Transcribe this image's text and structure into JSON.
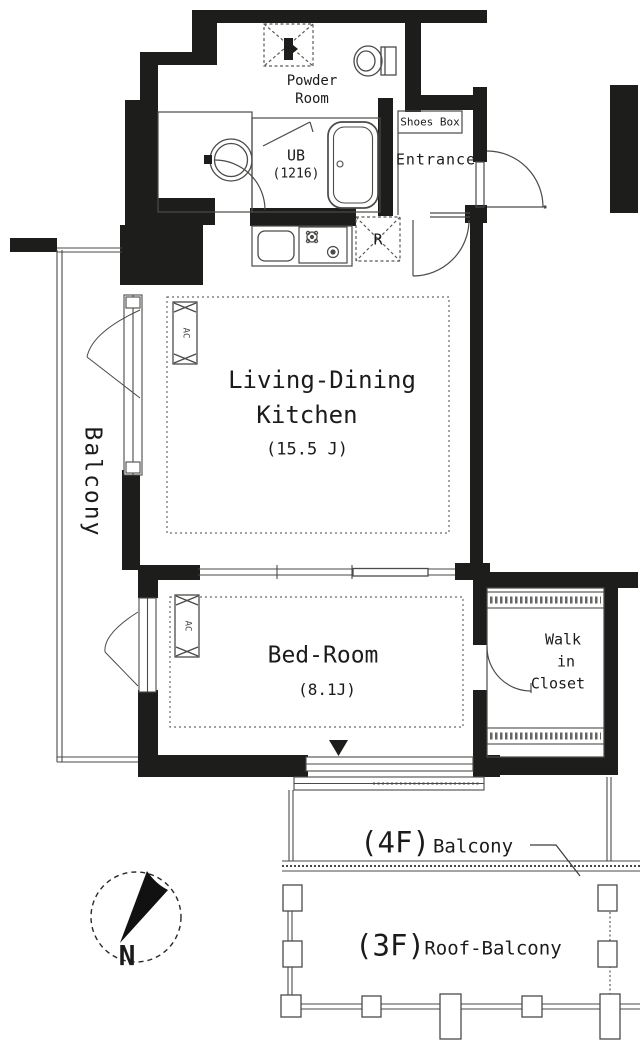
{
  "rooms": {
    "powder_room": {
      "line1": "Powder",
      "line2": "Room"
    },
    "unit_bath": {
      "label": "UB",
      "size": "(1216)"
    },
    "shoes_box": {
      "label": "Shoes Box"
    },
    "entrance": {
      "label": "Entrance"
    },
    "living_dining_kitchen": {
      "line1": "Living-Dining",
      "line2": "Kitchen",
      "size": "(15.5 J)"
    },
    "bedroom": {
      "label": "Bed-Room",
      "size": "(8.1J)"
    },
    "walk_in_closet": {
      "line1": "Walk",
      "line2": "in",
      "line3": "Closet"
    },
    "side_balcony": {
      "label": "Balcony"
    },
    "fourth_floor_balcony": {
      "floor": "(4F)",
      "label": "Balcony"
    },
    "third_floor_roof_balcony": {
      "floor": "(3F)",
      "label": "Roof-Balcony"
    }
  },
  "symbols": {
    "refrigerator": "R",
    "air_conditioner": "AC",
    "north": "N"
  },
  "colors": {
    "wall": "#1d1d1b",
    "line": "#4a4a48",
    "text": "#1b1b1b",
    "background": "#ffffff"
  }
}
